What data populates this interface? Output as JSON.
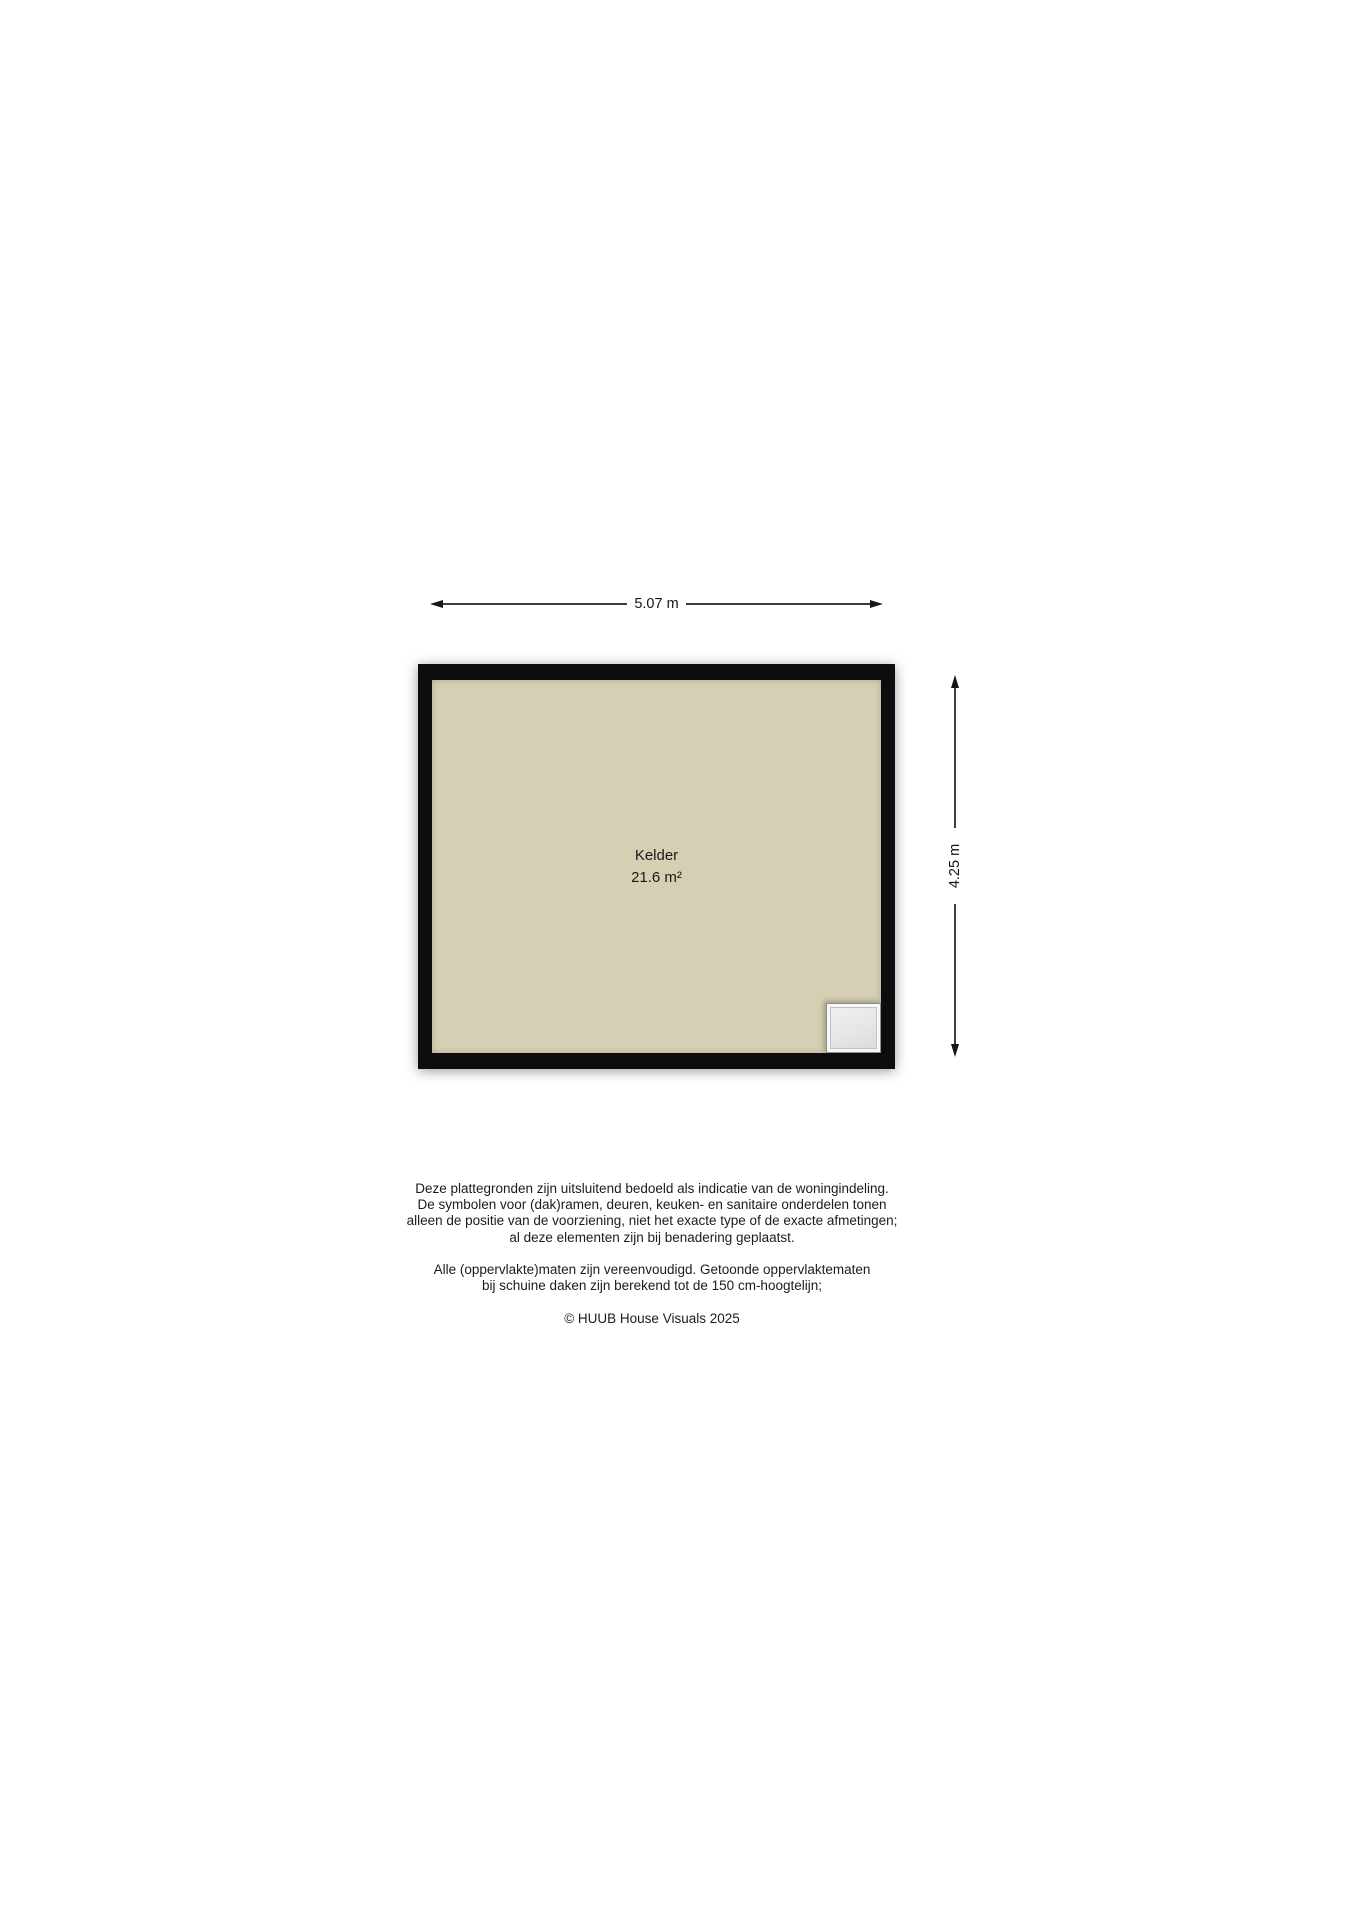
{
  "floorplan": {
    "room": {
      "name": "Kelder",
      "area": "21.6 m²"
    },
    "dimensions": {
      "width": "5.07 m",
      "height": "4.25 m"
    },
    "symbols": {
      "window": "basement-window-hatch"
    },
    "colors": {
      "floor": "#d5cfb3",
      "wall": "#0d0d0d",
      "dimension_line": "#3d3d3d"
    }
  },
  "footer": {
    "disclaimer_1": [
      "Deze plattegronden zijn uitsluitend bedoeld als indicatie van de woningindeling.",
      "De symbolen voor (dak)ramen, deuren, keuken- en sanitaire onderdelen tonen",
      "alleen de positie van de voorziening, niet het exacte type of de exacte afmetingen;",
      "al deze elementen zijn bij benadering geplaatst."
    ],
    "disclaimer_2": [
      "Alle (oppervlakte)maten zijn vereenvoudigd. Getoonde oppervlaktematen",
      "bij schuine daken zijn berekend tot de 150 cm-hoogtelijn;"
    ],
    "copyright": "© HUUB House Visuals 2025"
  }
}
